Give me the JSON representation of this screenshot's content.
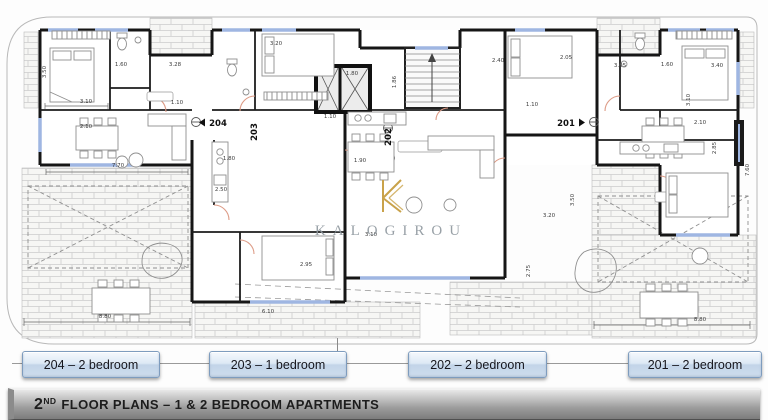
{
  "watermark": {
    "name": "KALOGIROU",
    "logo_letter": "K",
    "gold": "#c9a24a",
    "gray": "#8e979e"
  },
  "title_bar": {
    "prefix": "2",
    "superscript": "ND",
    "rest": " FLOOR PLANS – 1 & 2 BEDROOM APARTMENTS"
  },
  "buttons": [
    {
      "label": "204 – 2 bedroom"
    },
    {
      "label": "203 – 1 bedroom"
    },
    {
      "label": "202 – 2 bedroom"
    },
    {
      "label": "201 – 2 bedroom"
    }
  ],
  "plan": {
    "unit_labels": [
      {
        "text": "204",
        "x": 218,
        "y": 126,
        "arrow": "left"
      },
      {
        "text": "203",
        "x": 257,
        "y": 132,
        "rotate": true
      },
      {
        "text": "202",
        "x": 391,
        "y": 137,
        "rotate": true
      },
      {
        "text": "201",
        "x": 566,
        "y": 126,
        "arrow": "right"
      }
    ],
    "dimensions": [
      {
        "t": "3.10",
        "x": 86,
        "y": 103
      },
      {
        "t": "2.10",
        "x": 86,
        "y": 128
      },
      {
        "t": "1.60",
        "x": 121,
        "y": 66
      },
      {
        "t": "3.28",
        "x": 175,
        "y": 66
      },
      {
        "t": "1.10",
        "x": 177,
        "y": 104
      },
      {
        "t": "3.50",
        "x": 46,
        "y": 72,
        "r": 90
      },
      {
        "t": "7.70",
        "x": 118,
        "y": 167
      },
      {
        "t": "8.80",
        "x": 105,
        "y": 318
      },
      {
        "t": "2.50",
        "x": 221,
        "y": 191
      },
      {
        "t": "1.80",
        "x": 229,
        "y": 160
      },
      {
        "t": "2.95",
        "x": 306,
        "y": 266
      },
      {
        "t": "6.10",
        "x": 268,
        "y": 313
      },
      {
        "t": "3.20",
        "x": 276,
        "y": 45
      },
      {
        "t": "1.80",
        "x": 352,
        "y": 75
      },
      {
        "t": "1.86",
        "x": 396,
        "y": 82,
        "r": 90
      },
      {
        "t": "1.10",
        "x": 330,
        "y": 118
      },
      {
        "t": "3.10",
        "x": 371,
        "y": 236
      },
      {
        "t": "1.90",
        "x": 360,
        "y": 162
      },
      {
        "t": "2.05",
        "x": 566,
        "y": 59
      },
      {
        "t": "3.05",
        "x": 620,
        "y": 67
      },
      {
        "t": "1.60",
        "x": 667,
        "y": 66
      },
      {
        "t": "3.40",
        "x": 717,
        "y": 67
      },
      {
        "t": "2.40",
        "x": 498,
        "y": 62
      },
      {
        "t": "3.10",
        "x": 690,
        "y": 100,
        "r": 90
      },
      {
        "t": "2.10",
        "x": 700,
        "y": 124
      },
      {
        "t": "1.10",
        "x": 532,
        "y": 106
      },
      {
        "t": "3.20",
        "x": 549,
        "y": 217
      },
      {
        "t": "3.50",
        "x": 574,
        "y": 200,
        "r": 90
      },
      {
        "t": "2.75",
        "x": 530,
        "y": 271,
        "r": 90
      },
      {
        "t": "8.80",
        "x": 700,
        "y": 321
      },
      {
        "t": "7.60",
        "x": 749,
        "y": 170,
        "r": 90
      },
      {
        "t": "2.85",
        "x": 716,
        "y": 148,
        "r": 90
      }
    ]
  }
}
